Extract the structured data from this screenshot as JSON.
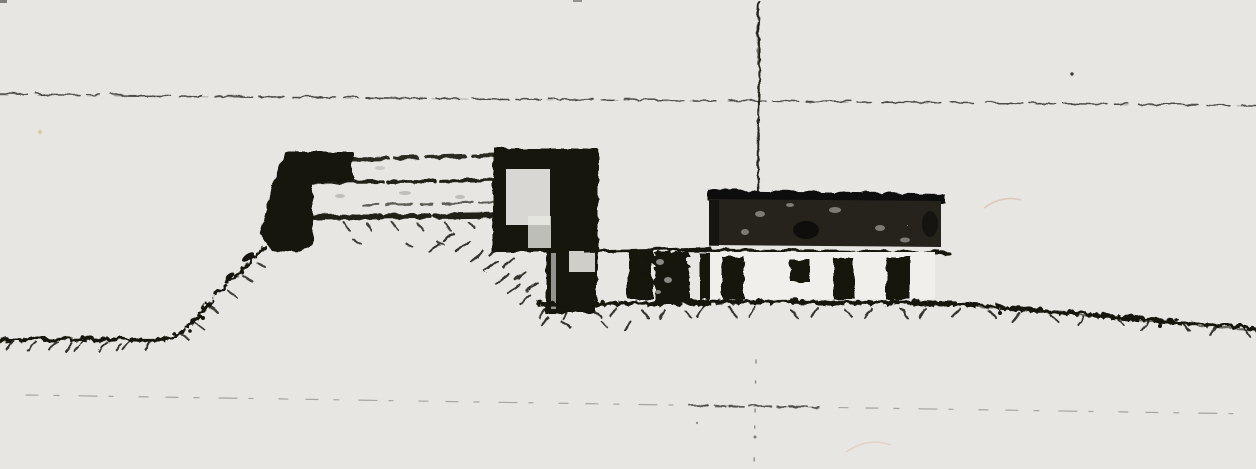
{
  "document": {
    "kind": "scanned-elevation-drawing",
    "visible_text": "none"
  },
  "colors": {
    "paper": "#e9e8e4",
    "wall_paper": "#f0efeb",
    "ink": "#17140f",
    "ink_soft": "#2a2723",
    "roof_fill": "#26221d",
    "guide_line": "#2f2d2a",
    "speck_gray": "#9a968f",
    "scratch_pink": "#d8a795",
    "speck_yellow": "#cdc289"
  },
  "scene": {
    "elements": [
      "top-guide-line",
      "center-axis-line",
      "bottom-guide-line",
      "left-ground-line",
      "hill-slope",
      "embankment-buttress",
      "entablature-lines",
      "checkered-tower",
      "middle-wall-posts",
      "right-building-roof",
      "right-building-wall",
      "door-openings",
      "window-opening",
      "right-ground-slope",
      "scan-artifacts"
    ]
  }
}
